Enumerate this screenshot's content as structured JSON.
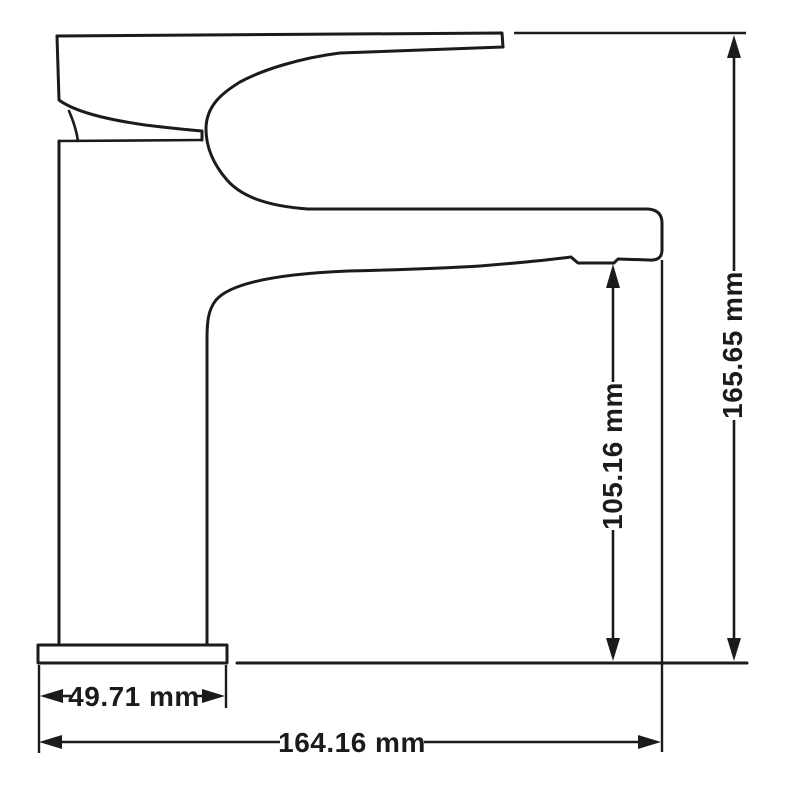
{
  "colors": {
    "line": "#1b1b1b",
    "background": "#ffffff"
  },
  "drawing": {
    "labels": {
      "overall_height": "165.65 mm",
      "spout_height": "105.16 mm",
      "base_width": "49.71 mm",
      "overall_length": "164.16 mm"
    }
  }
}
